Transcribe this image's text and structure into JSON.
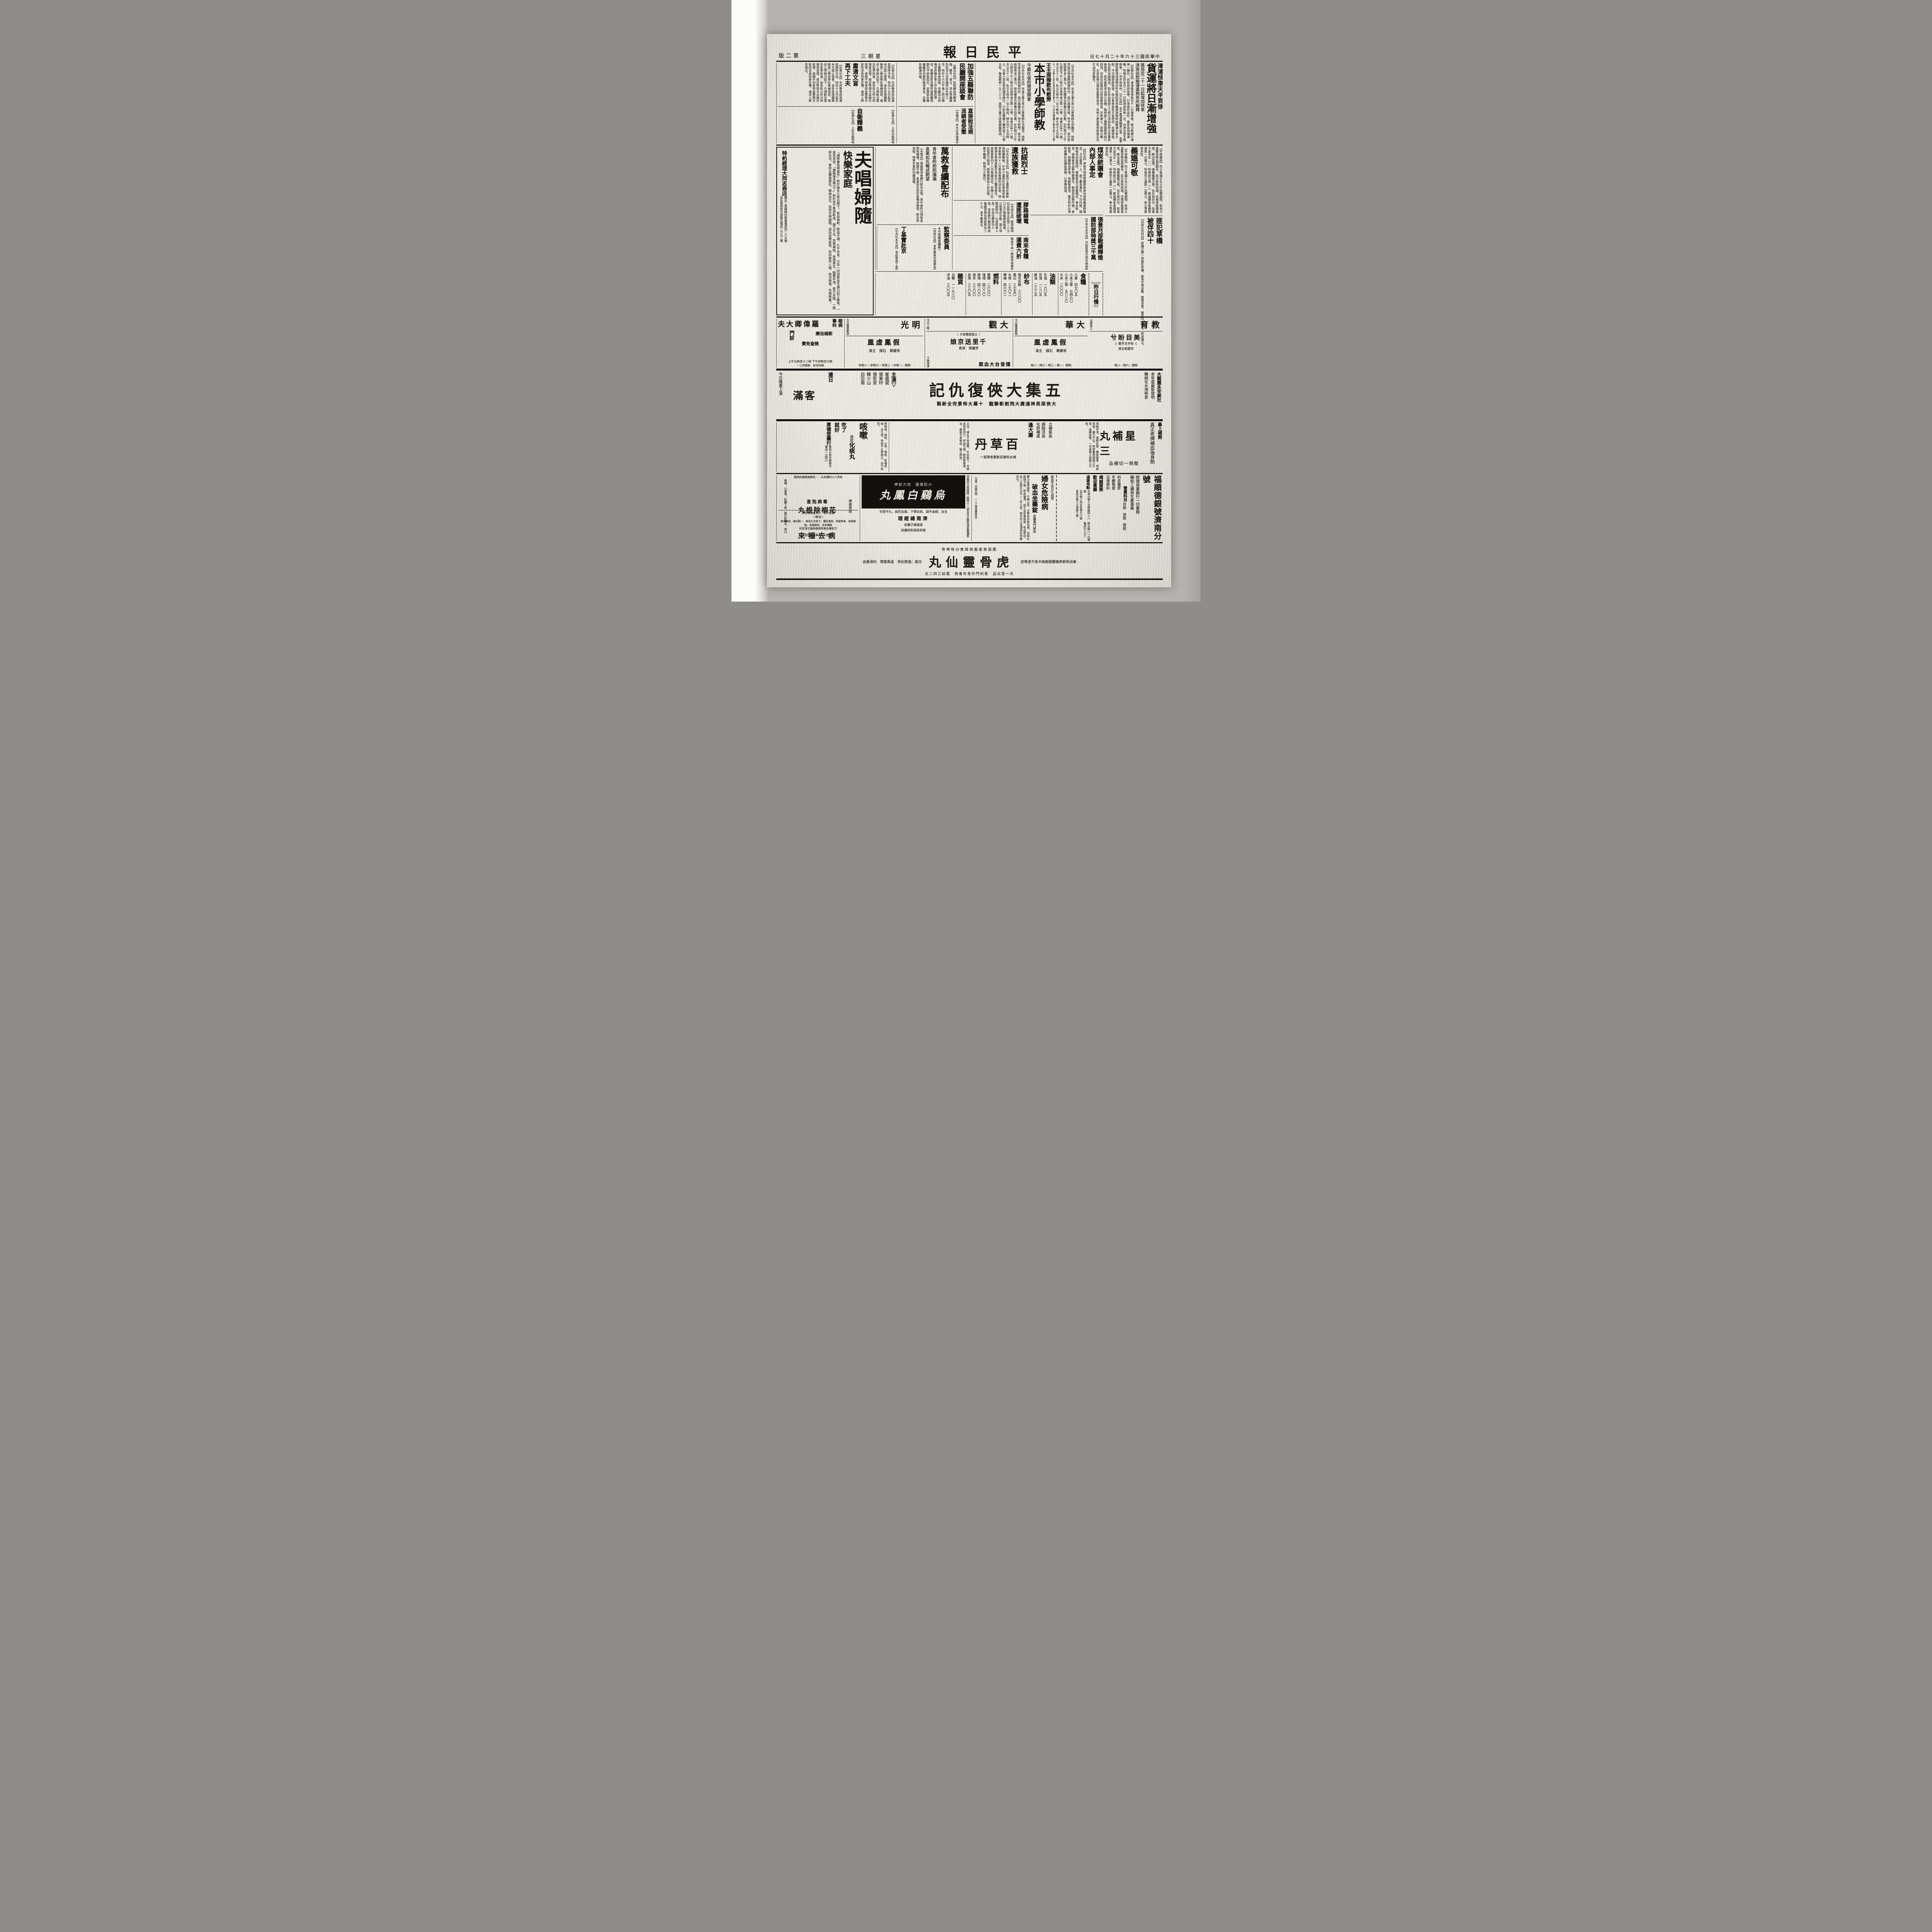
{
  "masthead": {
    "date": "中華民國三十六年十二月十七日",
    "title": "平民日報",
    "weekday": "星期三",
    "edition": "第二版"
  },
  "articles": {
    "jinpu": {
      "kicker": "津浦快車天半到徐",
      "headline": "貨運將日漸增強",
      "subs": "路局定二十一日起增加快車\n濟南站對搬運業務有所解釋",
      "body": "【民衆社訊】津浦路濟徐段自十一日通車後，每日除開行通車一輛外，尚有各段加車，行車情形良好，路局為加強運輸，特預定自本月二十一日起增加快車一次，自濟出發不需換車，一天半到徐州。【大社訊】本市搬運業職業公會，為事變前膠濟津浦兩站所有裝卸貨車搬運貨物統由搬運公會分配，今交通即將恢復，該公會惟恐有歹徒把持，有礙復員，為此特呈請路局，對於各站裝卸工人即以濟南站昨已答覆此後管理，原有業務清淡減少名額，臨時雇工實際需要時再行招用。自由社訊路局以前並無制度，早經廢止，貨物已暢旺，北來貨物以煤炭茶葉等為多，其他土產黑棗柿餅棉花花生油均甚暢旺。"
    },
    "wang": {
      "kicker": "王主席撥款布慰勞",
      "headline": "本市小學師教",
      "sub": "今晨在省府禮堂開會",
      "body": "【中央社本市訊】本省王兼主席以小學教師生活艱苦，除經常設法增進教師福利外，茲以歲暮天寒，特予慰勞，當令發給慰勞金三萬元，飭有關單位統籌分別召集，定於明日上午九時及下午三時分在商埠省立第一小學、省會分區十八處、市立五十二校、私立五校共一百十餘校，師生四千五百餘人，化會十堂及省府禮堂舉行，六校及機關工廠附設三小學五校，輪值教師一五二三人，屆時王兼主席將親臨致詞。"
    },
    "lianfang": {
      "headline": "加強五縣聯防\n民廳開座談會",
      "body": "【勵志社訊】民政廳為明瞭濟陽、鄒平、章丘、泗水等縣聯防狀況以及各縣研討冬季工作，特於十六日午後二時召開五縣縣長座談會，各縣長分別陳述其縣冬季工作及聯防事宜，劉廳長對各縣所提困難問題均予詳悉指示，並發給各縣繼續密切聯防辦理事宜，亦獲有圓滿決議。"
    },
    "sumang": {
      "headline": "肅清文盲\n再下工夫",
      "body": "【民衆社訊】市府教育局為澈底掃除文盲，特自十五日起至本月底止復查，並各區接續開辦第二期失學民衆補習班，強迫入學辦法如下：凡適齡兒童及失學民衆，由各區公所分別調查造冊，限定時間令其親往就學，逾期不到者即由警察分駐所派員持册往傳，或派人將其領出。"
    },
    "shuifa": {
      "headline": "直接稅法規\n派銷者受懲",
      "body": "【本報訊】本市近來發現有人假借直接稅法規派銷圖利情事，該局對於此種情形特佈告周知，凡有以直接稅法規做名非法派銷索取高價者，無論何人一經查獲，除沒收其書刊外並從嚴懲處，肅清此種流弊，各業公會應自行查禁，毋再受騙上當。"
    },
    "ziwei": {
      "headline": "自衛釋義",
      "body": "【民衆社訊】人民自衛問題，於昨日第二次座談會中，就人民自衛武力及建軍問題與地方團隊，為省縣保安隊之編制、人民自衛武力之運用等，操練人民自由自衛，並武力與地方團隊，為省縣保安之用，會議結論於日昨上午討論。"
    },
    "kangsui": {
      "headline": "抗綏烈士\n遺族獲救",
      "body": "【中央社本市訊】抗綏烈士遺族於春節前將獲撫救，中央十遺族於此事係省振濟會第四十八次委員會議所決定者，得救濟金惟發放數目及此次之籌措辦法，由救會第四十八次會議決定。安隊人民自衛武力組成，按照鄉鎮由人民自衛，槍不離鄉，衛地方之責任。"
    },
    "wanjiu": {
      "headline": "萬救會續配布",
      "sub1": "青年會昨熙熙攘攘",
      "sub2": "袁業如氏暢述期望",
      "body": "【本報訊】萬國救濟會續行配布衣物，青年會昨日領取者熙熙攘攘，絡繹不絕，袁業如氏對記者暢述期望，盼各界協助，俾寒冬貧民均獲溫暖。"
    },
    "jiaolu": {
      "headline": "膠路線電\n遭匪破壞",
      "body": "【自由社訊】膠濟線周村莊與梁王莊間二八五〇公尺電線被匪破壞，以致電訊中斷，現正加緊搶修中，以憑核發人員，另造功績表功人員，並飭將作戰部隊由聯總部隊有發給獎金三千元，准予備案云。"
    },
    "nanlai": {
      "headline": "南來食糧\n運費六折",
      "body": "路局今為一般南來食粮起見，特將南來食粮運費打六折，將南來與南浦段食粮運費特予減低，東北兩方面來濟食粮之運發照舊，每公斤三百六十五元計算，劃一運費，面來濟食粮之運發照舊。"
    },
    "jiancha": {
      "headline": "監察委員",
      "note": "▲不得兼省議員▽",
      "body": "【自由社訊】省參議員自當選為監察委員後，能否兼任省參議員問題，現已有指示：當選為監察委員者，省參議員不得兼任，當選為監委後其省議員員缺，謂行政院問常選為省監察委遞補。"
    },
    "dingji": {
      "headline": "丁基實赴京",
      "body": "【中央社本市訊】省府委員丁基實氏，頃因公赴京。"
    },
    "meitan": {
      "headline": "煤炭統購會\n內部人事定",
      "body": "【同社訊】濟南市煤炭統購委員會內部組織業經確定，主任委員一人，由丁廳長兼任，下分四組，總務組長為張煒郊，業務組長王基實擔任，會計組長、運輸組長由劉仲齋擔任，副組長為劉竹齋、家新等。探購組長李雨，為解救煤荒，聞氏特於必濟時將轉赴該礦區視察，以準備啟運。"
    },
    "zhangjing": {
      "headline": "張景月部戰績輝煌\n國防部特獎三千萬",
      "body": "【中央社本市訊】月前張景月部卒挫頑敵，激戰確保重鎮，戰績輝煌，國防部頃特獎三千萬元以慰將士，並准予備案外，特犒賞嘉許，另由聯總部隊加獎，作救濟戰士遺族之用，殊堪嘉尚，頒發獎狀以資鼓勵。"
    },
    "yiao": {
      "headline": "義媼可敬",
      "body": "【平度縣訊】烈士崔瑞正女士於抗戰期間，對地方遊擊部隊協助頗多，此次匪陷該城，氏倡導救護傷患，厥功甚偉，誠屬義媼可敬。尚在商討中，該會今並決定（一）特救前已故（二）鄆城縣長黃鏡環遺族一百萬元，特救烈士遺族一百萬元，焦士等要案多起。"
    },
    "feifan": {
      "headline": "匪犯草橋\n被俘四十",
      "body": "【自由社兗州訊】匪獨立團一部竄犯草橋，經我守軍迎擊，斃傷甚眾，被俘四十餘名，時間獨立。"
    }
  },
  "market": {
    "deco_top": "◇△△◇",
    "title": "昨日行情",
    "deco_bottom": "▽▽",
    "sections": [
      {
        "name": "食糧",
        "items": [
          "小麥　四七〇五",
          "小米三等　七四六〇",
          "小米二等　五八三〇",
          "大米　二〇〇〇"
        ]
      },
      {
        "name": "油類",
        "items": [
          "生油　一六〇五",
          "豆油　一二八五",
          "香油　二三二五"
        ]
      },
      {
        "name": "紗布",
        "items": [
          "棉花名駒　三八〇〇",
          "鳳山　三七五〇",
          "丸珠　二七〇二",
          "嗶嘰　四六六二"
        ]
      },
      {
        "name": "燃料",
        "items": [
          "雙鹽　二六六〇",
          "塊煤　四〇二〇",
          "飾煤　四二〇〇",
          "煤末　三三〇〇",
          "泉煤　三三〇五"
        ]
      },
      {
        "name": "雜貨",
        "items": [
          "白糖　一一九八〇",
          "洋油　三〇〇五"
        ]
      }
    ]
  },
  "cinemas": {
    "edu": {
      "name": "教育",
      "tag": "山東省立",
      "film": "美目盼兮",
      "note": "《有中文字幕》",
      "cast": "安娜妮主演",
      "times": "時間：六時・八時"
    },
    "dahua": {
      "name": "大華",
      "head": "今日隆重獻映",
      "film": "假鳳虛凰",
      "cast": "李麗華　石揮　主演",
      "times": "時間：一時・三時・六時・八時"
    },
    "daguan": {
      "name": "大觀",
      "head": "今日上映",
      "tag": "〔古裝香豔鉅片〕",
      "film": "千里送京娘",
      "cast": "李麗華　賀賓",
      "next": "播音台大血案",
      "next_note": "下期准演",
      "times": "時間：十點半・三點・六點・八點"
    },
    "ming": {
      "name": "明光",
      "head": "今日隆重獻演",
      "film": "假鳳虛凰",
      "cast": "李麗華　石揮　主演",
      "times": "時間：一時半・三時半・六時半・八時半"
    },
    "doctor": {
      "name": "羅偉卿大夫",
      "spec": "眼病\n專科",
      "line1": "新械治療",
      "line2": "檢查免費",
      "menzhen": "門診",
      "times": "上午九時至十二時\n下午四時至六時",
      "note": "婦科往診　掛號四三一"
    }
  },
  "theater": {
    "troupe": "大觀園永安劇社",
    "line1": "本年度最新發明",
    "line2": "機械化水洩佈景",
    "title": "五集大俠復仇記",
    "sub": "大俠梁英神通廣大飛劍斬摯龍　十幕大佈景完全新製",
    "cast_label": "主演▽",
    "cast": [
      "崔盛斌",
      "張美玲",
      "張宏安",
      "韓少山",
      "白亞南"
    ],
    "full1": "連日",
    "full2": "客滿",
    "today": "今日隆重上演"
  },
  "meds": {
    "sanxing": {
      "kicker": "最上補劑",
      "line": "真正老牌補血強身劑",
      "name": "三星補丸",
      "tag": "壓倒一切補品",
      "body": "滑精早洩、遺精失勢、腰痠腿疼、神經衰弱、腦力不足，用興奮劑調服之立效，強腰固精，一切虛弱之症服之立效。",
      "side": "立補氣血"
    },
    "baicao": {
      "kicker": "調經活血\n化瘀補虛",
      "line": "婦女科馳名聖藥老牌第一",
      "promo": "逢大廉",
      "name": "百草丹",
      "body": "主治：婦女子宮虛寒、吐血帶下、月經血忽多忽少、停血不調、經色黑紫或淡、婚後不育等症，服之神效。"
    },
    "kesou": {
      "big": "咳嗽",
      "relief": "吃了\n就好",
      "pre": "速效",
      "name": "化痰丸",
      "body": "師傅咳、勞咳、火咳、喘咳、氣喘痰咳、百日咳，常咳不止者服之，永不再犯。",
      "seller": "厚德堂藥行",
      "addr": "普利大街中間路北\n電話一五四六"
    }
  },
  "bottom": {
    "bank": {
      "name": "福順德銀號濟南分號",
      "line1": "辦理商業銀行一切業務",
      "line2": "輔助工礦商生產事業",
      "biz_label": "營業科目",
      "biz": "存款　放款　匯款",
      "feats": "利息優厚\n手續簡便\n迅速便利",
      "slogans": "竭誠服務\n歡迎惠顧",
      "remit_label": "通匯地點",
      "remits": "天津分號＝吉林路四十八號\n北平號＝四交民巷九十號\n青島分號＝天津路十號",
      "addr": "緯五路八一九號\n電話九八五一"
    },
    "funv": {
      "headline": "婦女危險病",
      "name": "破血坐藥錠",
      "intro": "此藥專門破血",
      "body": "藥力直達病所，不損元氣，且無如自取毛病。治婦女經閉不通、瘀血凝滯、血不見氣裏血聚、乾血勞症，由三五個月以至一二年之症，按月份之深淺用此坐藥皆可。",
      "note": "（注意：孕婦忌用　一二三號坐藥每粒）",
      "side": "經血不見日久成勞",
      "maker": "北平鄒家藥局藥之一"
    },
    "wuji": {
      "slogan": "小粒易服　効力如神",
      "name": "烏鷄白鳳丸",
      "cure": "主治：經血不調、赤白帶下、婦女百病、久不受孕",
      "mgr": "濟南總經理",
      "seller1": "張路樂子藥房",
      "seller2": "普利街馬利四藥房",
      "side": "濟南四大馬路緯二路四十一號友光大藥房馮家藥舖售"
    },
    "hualiu": {
      "kicker": "毒病剋星",
      "name": "花柳除根丸",
      "top": "各界人士均讚本丸・・花柳病根服此除根",
      "items": "楊梅、口便毒、紅腫下疳、破打針藥水、魚口",
      "tag": "神速見效",
      "addr": "四巷口　大華電影院旁"
    },
    "bingqu": {
      "top": "藥性平和　六天後准保你好",
      "root": "◁根治▷",
      "list": "黃爛多淨、四肢痠疼、脫髮落眉、串骨痠疼、餘毒紅腫、下疳年久毛病、一點未破、耳痛未發",
      "line": "打針藥丸無效者趕快服它准定好",
      "name": "病去福來",
      "seller": "◇經售處◇",
      "addr1": "經四巷口首三號得殘堂內",
      "addr2": "緯三路南鄰車鋪均售"
    }
  },
  "banner": {
    "top": "歷屆患者服用與實分效神奇",
    "right": "專治骨節疼痛腰腿痠麻半身不遂等症",
    "name": "虎骨靈仙丸",
    "left": "功能：強筋壯骨　追風散寒　利濕養血",
    "bottom": "天一堂出品　普利門外青年會西　電話三四二五"
  }
}
